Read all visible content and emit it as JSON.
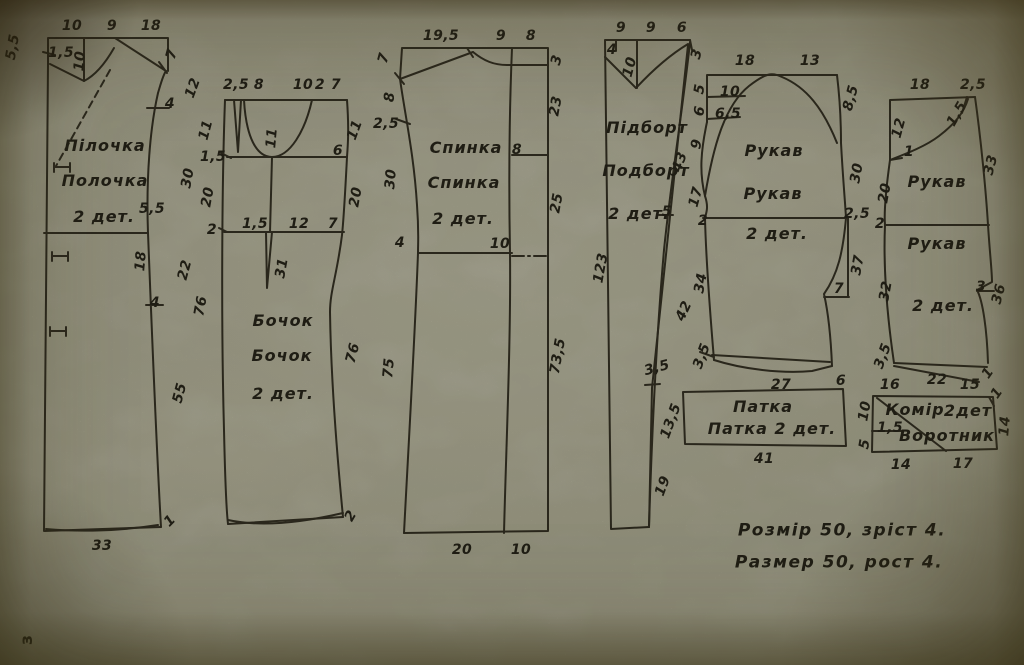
{
  "page": {
    "page_number": "з"
  },
  "footer": {
    "line1": "Розмір 50,  зріст 4.",
    "line2": "Размер 50,  рост 4.",
    "labels": [
      {
        "t": "Розмір 50,  зріст 4.",
        "x": 842,
        "y": 531,
        "s": "b",
        "n": "size-note-line-ukrainian"
      },
      {
        "t": "Размер 50,  рост 4.",
        "x": 839,
        "y": 563,
        "s": "b",
        "n": "size-note-line-russian"
      }
    ]
  },
  "ink_color": "#2a271c",
  "paper_color": "#a8a794",
  "pieces": [
    {
      "id": "front-piece",
      "title": "Пілочка / Полочка",
      "quantity": "2 дет.",
      "labels": [
        {
          "t": "10",
          "x": 72,
          "y": 26
        },
        {
          "t": "9",
          "x": 112,
          "y": 26
        },
        {
          "t": "18",
          "x": 151,
          "y": 26
        },
        {
          "t": "5,5",
          "x": 13,
          "y": 47,
          "r": -80
        },
        {
          "t": "1,5",
          "x": 61,
          "y": 53
        },
        {
          "t": "10",
          "x": 80,
          "y": 61,
          "r": -85
        },
        {
          "t": "7",
          "x": 172,
          "y": 54,
          "r": -75
        },
        {
          "t": "12",
          "x": 193,
          "y": 88,
          "r": -70
        },
        {
          "t": "4",
          "x": 170,
          "y": 104
        },
        {
          "t": "30",
          "x": 188,
          "y": 178,
          "r": -80
        },
        {
          "t": "5,5",
          "x": 152,
          "y": 209
        },
        {
          "t": "18",
          "x": 141,
          "y": 261,
          "r": -85
        },
        {
          "t": "22",
          "x": 185,
          "y": 270,
          "r": -75
        },
        {
          "t": "4",
          "x": 155,
          "y": 303
        },
        {
          "t": "55",
          "x": 180,
          "y": 393,
          "r": -75
        },
        {
          "t": "1",
          "x": 170,
          "y": 521,
          "r": -45
        },
        {
          "t": "33",
          "x": 102,
          "y": 546
        },
        {
          "t": "Пілочка",
          "x": 105,
          "y": 146,
          "s": "t",
          "n": "piece-title"
        },
        {
          "t": "Полочка",
          "x": 105,
          "y": 181,
          "s": "t",
          "n": "piece-title"
        },
        {
          "t": "2 дет.",
          "x": 104,
          "y": 217,
          "s": "t",
          "n": "piece-quantity"
        }
      ]
    },
    {
      "id": "side-piece",
      "title": "Бочок / Бочок",
      "quantity": "2 дет.",
      "labels": [
        {
          "t": "2,5",
          "x": 236,
          "y": 85
        },
        {
          "t": "8",
          "x": 259,
          "y": 85
        },
        {
          "t": "10",
          "x": 303,
          "y": 85
        },
        {
          "t": "2",
          "x": 320,
          "y": 85
        },
        {
          "t": "7",
          "x": 336,
          "y": 85
        },
        {
          "t": "11",
          "x": 206,
          "y": 130,
          "r": -75
        },
        {
          "t": "1,5",
          "x": 213,
          "y": 157
        },
        {
          "t": "20",
          "x": 208,
          "y": 197,
          "r": -80
        },
        {
          "t": "2",
          "x": 212,
          "y": 230
        },
        {
          "t": "11",
          "x": 272,
          "y": 138,
          "r": -85
        },
        {
          "t": "6",
          "x": 338,
          "y": 151
        },
        {
          "t": "11",
          "x": 355,
          "y": 130,
          "r": -70
        },
        {
          "t": "20",
          "x": 356,
          "y": 197,
          "r": -80
        },
        {
          "t": "1,5",
          "x": 255,
          "y": 224
        },
        {
          "t": "12",
          "x": 299,
          "y": 224
        },
        {
          "t": "7",
          "x": 333,
          "y": 224
        },
        {
          "t": "31",
          "x": 282,
          "y": 268,
          "r": -80
        },
        {
          "t": "76",
          "x": 201,
          "y": 306,
          "r": -80
        },
        {
          "t": "76",
          "x": 353,
          "y": 353,
          "r": -75
        },
        {
          "t": "2",
          "x": 351,
          "y": 516,
          "r": -60
        },
        {
          "t": "Бочок",
          "x": 283,
          "y": 321,
          "s": "t",
          "n": "piece-title"
        },
        {
          "t": "Бочок",
          "x": 282,
          "y": 356,
          "s": "t",
          "n": "piece-title"
        },
        {
          "t": "2 дет.",
          "x": 283,
          "y": 394,
          "s": "t",
          "n": "piece-quantity"
        }
      ]
    },
    {
      "id": "back-piece",
      "title": "Спинка / Спинка",
      "quantity": "2 дет.",
      "labels": [
        {
          "t": "19,5",
          "x": 441,
          "y": 36
        },
        {
          "t": "9",
          "x": 501,
          "y": 36
        },
        {
          "t": "8",
          "x": 531,
          "y": 36
        },
        {
          "t": "7",
          "x": 384,
          "y": 58,
          "r": -75
        },
        {
          "t": "8",
          "x": 390,
          "y": 97,
          "r": -85
        },
        {
          "t": "2,5",
          "x": 386,
          "y": 124
        },
        {
          "t": "30",
          "x": 391,
          "y": 179,
          "r": -85
        },
        {
          "t": "4",
          "x": 400,
          "y": 243
        },
        {
          "t": "75",
          "x": 389,
          "y": 368,
          "r": -85
        },
        {
          "t": "3",
          "x": 557,
          "y": 60,
          "r": -75
        },
        {
          "t": "23",
          "x": 556,
          "y": 106,
          "r": -80
        },
        {
          "t": "8",
          "x": 517,
          "y": 150
        },
        {
          "t": "25",
          "x": 557,
          "y": 203,
          "r": -80
        },
        {
          "t": "10",
          "x": 500,
          "y": 244
        },
        {
          "t": "73,5",
          "x": 558,
          "y": 356,
          "r": -80
        },
        {
          "t": "20",
          "x": 462,
          "y": 550
        },
        {
          "t": "10",
          "x": 521,
          "y": 550
        },
        {
          "t": "Спинка",
          "x": 466,
          "y": 148,
          "s": "t",
          "n": "piece-title"
        },
        {
          "t": "Спинка",
          "x": 464,
          "y": 183,
          "s": "t",
          "n": "piece-title"
        },
        {
          "t": "2 дет.",
          "x": 463,
          "y": 219,
          "s": "t",
          "n": "piece-quantity"
        }
      ]
    },
    {
      "id": "facing-piece",
      "title": "Підборт / Подборт",
      "quantity": "2 дет.",
      "labels": [
        {
          "t": "9",
          "x": 621,
          "y": 28
        },
        {
          "t": "9",
          "x": 651,
          "y": 28
        },
        {
          "t": "6",
          "x": 682,
          "y": 28
        },
        {
          "t": "4",
          "x": 612,
          "y": 50
        },
        {
          "t": "10",
          "x": 630,
          "y": 67,
          "r": -75
        },
        {
          "t": "3",
          "x": 697,
          "y": 54,
          "r": -75
        },
        {
          "t": "43",
          "x": 680,
          "y": 162,
          "r": -70
        },
        {
          "t": "5",
          "x": 667,
          "y": 212
        },
        {
          "t": "123",
          "x": 601,
          "y": 268,
          "r": -80
        },
        {
          "t": "42",
          "x": 684,
          "y": 311,
          "r": -65
        },
        {
          "t": "3,5",
          "x": 657,
          "y": 368,
          "r": -15
        },
        {
          "t": "13,5",
          "x": 671,
          "y": 421,
          "r": -70
        },
        {
          "t": "19",
          "x": 663,
          "y": 486,
          "r": -70
        },
        {
          "t": "Підборт",
          "x": 647,
          "y": 128,
          "s": "t",
          "n": "piece-title"
        },
        {
          "t": "Подборт",
          "x": 646,
          "y": 171,
          "s": "t",
          "n": "piece-title"
        },
        {
          "t": "2 дет.",
          "x": 639,
          "y": 214,
          "s": "t",
          "n": "piece-quantity"
        }
      ]
    },
    {
      "id": "sleeve-top-piece",
      "title": "Рукав / Рукав",
      "quantity": "2 дет.",
      "labels": [
        {
          "t": "18",
          "x": 745,
          "y": 61
        },
        {
          "t": "13",
          "x": 810,
          "y": 61
        },
        {
          "t": "5",
          "x": 700,
          "y": 89,
          "r": -80
        },
        {
          "t": "6",
          "x": 700,
          "y": 111,
          "r": -80
        },
        {
          "t": "9",
          "x": 697,
          "y": 144,
          "r": -80
        },
        {
          "t": "17",
          "x": 696,
          "y": 197,
          "r": -75
        },
        {
          "t": "2",
          "x": 703,
          "y": 221
        },
        {
          "t": "10",
          "x": 730,
          "y": 92
        },
        {
          "t": "6,5",
          "x": 728,
          "y": 114
        },
        {
          "t": "8,5",
          "x": 851,
          "y": 98,
          "r": -75
        },
        {
          "t": "30",
          "x": 857,
          "y": 173,
          "r": -80
        },
        {
          "t": "2,5",
          "x": 857,
          "y": 214
        },
        {
          "t": "37",
          "x": 858,
          "y": 265,
          "r": -80
        },
        {
          "t": "7",
          "x": 839,
          "y": 289
        },
        {
          "t": "34",
          "x": 701,
          "y": 283,
          "r": -80
        },
        {
          "t": "3,5",
          "x": 702,
          "y": 356,
          "r": -70
        },
        {
          "t": "27",
          "x": 781,
          "y": 385
        },
        {
          "t": "6",
          "x": 841,
          "y": 381
        },
        {
          "t": "Рукав",
          "x": 774,
          "y": 151,
          "s": "t",
          "n": "piece-title"
        },
        {
          "t": "Рукав",
          "x": 773,
          "y": 194,
          "s": "t",
          "n": "piece-title"
        },
        {
          "t": "2 дет.",
          "x": 777,
          "y": 234,
          "s": "t",
          "n": "piece-quantity"
        }
      ]
    },
    {
      "id": "sleeve-under-piece",
      "title": "Рукав / Рукав",
      "quantity": "2 дет.",
      "labels": [
        {
          "t": "18",
          "x": 920,
          "y": 85
        },
        {
          "t": "2,5",
          "x": 973,
          "y": 85
        },
        {
          "t": "12",
          "x": 899,
          "y": 128,
          "r": -75
        },
        {
          "t": "1,5",
          "x": 957,
          "y": 114,
          "r": -60
        },
        {
          "t": "1",
          "x": 909,
          "y": 152
        },
        {
          "t": "20",
          "x": 885,
          "y": 193,
          "r": -80
        },
        {
          "t": "2",
          "x": 880,
          "y": 224
        },
        {
          "t": "33",
          "x": 991,
          "y": 165,
          "r": -75
        },
        {
          "t": "32",
          "x": 886,
          "y": 291,
          "r": -80
        },
        {
          "t": "3",
          "x": 981,
          "y": 287
        },
        {
          "t": "36",
          "x": 999,
          "y": 294,
          "r": -75
        },
        {
          "t": "3,5",
          "x": 883,
          "y": 356,
          "r": -70
        },
        {
          "t": "22",
          "x": 937,
          "y": 380
        },
        {
          "t": "1",
          "x": 988,
          "y": 373,
          "r": -55
        },
        {
          "t": "Рукав",
          "x": 937,
          "y": 182,
          "s": "t",
          "n": "piece-title"
        },
        {
          "t": "Рукав",
          "x": 937,
          "y": 244,
          "s": "t",
          "n": "piece-title"
        },
        {
          "t": "2 дет.",
          "x": 943,
          "y": 306,
          "s": "t",
          "n": "piece-quantity"
        }
      ]
    },
    {
      "id": "tab-piece",
      "title": "Патка / Патка",
      "quantity": "2 дет.",
      "labels": [
        {
          "t": "Патка",
          "x": 763,
          "y": 407,
          "s": "t",
          "n": "piece-title"
        },
        {
          "t": "Патка  2 дет.",
          "x": 772,
          "y": 429,
          "s": "t",
          "n": "piece-title"
        },
        {
          "t": "41",
          "x": 764,
          "y": 459
        }
      ]
    },
    {
      "id": "collar-piece",
      "title": "Комір / Воротник",
      "quantity": "2дет",
      "labels": [
        {
          "t": "16",
          "x": 890,
          "y": 385
        },
        {
          "t": "15",
          "x": 970,
          "y": 385
        },
        {
          "t": "1",
          "x": 997,
          "y": 393,
          "r": -55
        },
        {
          "t": "10",
          "x": 865,
          "y": 411,
          "r": -80
        },
        {
          "t": "1,5",
          "x": 890,
          "y": 428
        },
        {
          "t": "5",
          "x": 865,
          "y": 444,
          "r": -80
        },
        {
          "t": "14",
          "x": 1005,
          "y": 426,
          "r": -85
        },
        {
          "t": "14",
          "x": 901,
          "y": 465
        },
        {
          "t": "17",
          "x": 963,
          "y": 464
        },
        {
          "t": "Комір",
          "x": 915,
          "y": 410,
          "s": "t",
          "n": "piece-title"
        },
        {
          "t": "2дет",
          "x": 968,
          "y": 411,
          "s": "t",
          "n": "piece-quantity"
        },
        {
          "t": "Воротник",
          "x": 947,
          "y": 436,
          "s": "t",
          "n": "piece-title"
        }
      ]
    }
  ]
}
